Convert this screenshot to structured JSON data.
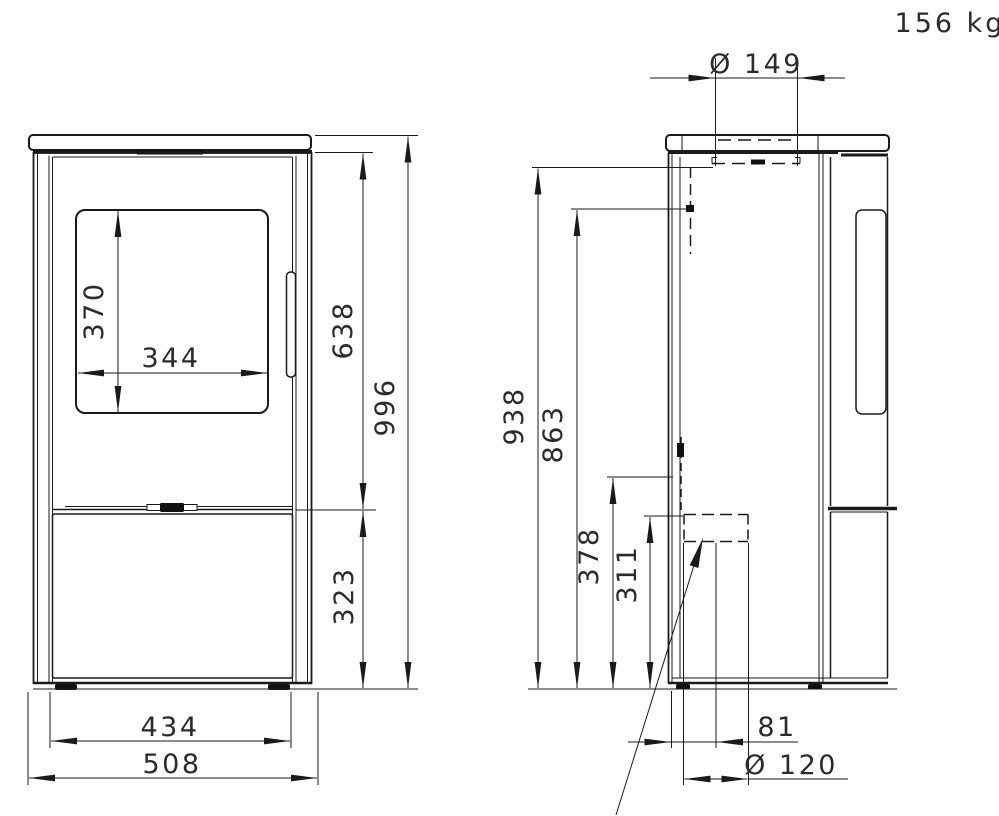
{
  "title_block": {
    "weight": "156 kg"
  },
  "front_view": {
    "name": "stove-front-view",
    "dims": {
      "glass_height": "370",
      "glass_width": "344",
      "top_to_door_bottom": "638",
      "overall_height": "996",
      "bottom_section_height": "323",
      "foot_width": "434",
      "overall_width": "508"
    }
  },
  "side_view": {
    "name": "stove-side-view",
    "dims": {
      "flue_collar_diameter": "Ø 149",
      "floor_to_flue_collar": "938",
      "floor_to_rear_flue_center": "863",
      "floor_to_upper_connection": "378",
      "floor_to_air_intake_top": "311",
      "rear_to_intake_center": "81",
      "air_intake_diameter": "Ø 120"
    }
  },
  "colors": {
    "line": "#1a1a1a",
    "text": "#2b2b2b",
    "background": "#ffffff"
  }
}
